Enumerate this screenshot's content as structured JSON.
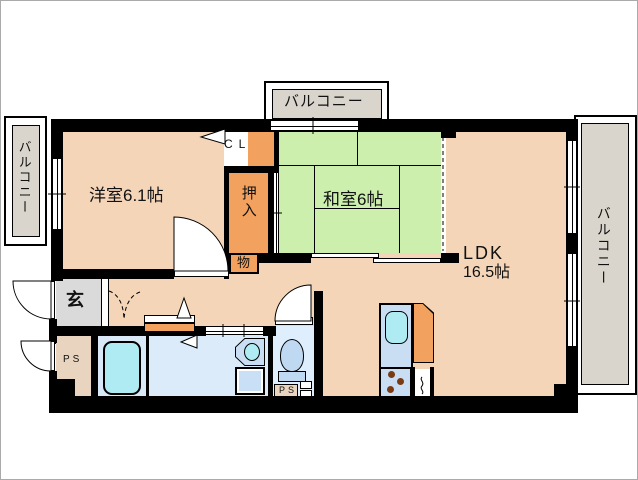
{
  "title": "マンション間取り図",
  "colors": {
    "wall": "#000000",
    "room_floor": "#F4D5B8",
    "tatami_green": "#CDEFAE",
    "closet_orange": "#F2A25E",
    "balcony_gray": "#D9D5CC",
    "entrance_gray": "#DADADA",
    "pipe_space_tan": "#E8D4BF",
    "wet_room_blue": "#DCEBFA",
    "fixture_cyan": "#AEEBF2",
    "kitchen_counter_blue": "#C9DEF3",
    "burner_brown": "#7A3A12"
  },
  "rooms": {
    "balcony_top": {
      "label": "バルコニー"
    },
    "balcony_left": {
      "label": "バルコニー"
    },
    "balcony_right": {
      "label": "バルコニー"
    },
    "western_room": {
      "label": "洋室6.1帖"
    },
    "japanese_room": {
      "label": "和室6帖"
    },
    "ldk": {
      "label_line1": "LDK",
      "label_line2": "16.5帖"
    },
    "closet": {
      "label": "CL"
    },
    "oshiire": {
      "label": "押入"
    },
    "storage": {
      "label": "物"
    },
    "entrance": {
      "label": "玄"
    },
    "pipe_space_left": {
      "label": "PS"
    },
    "pipe_space_toilet": {
      "label": "PS"
    }
  }
}
